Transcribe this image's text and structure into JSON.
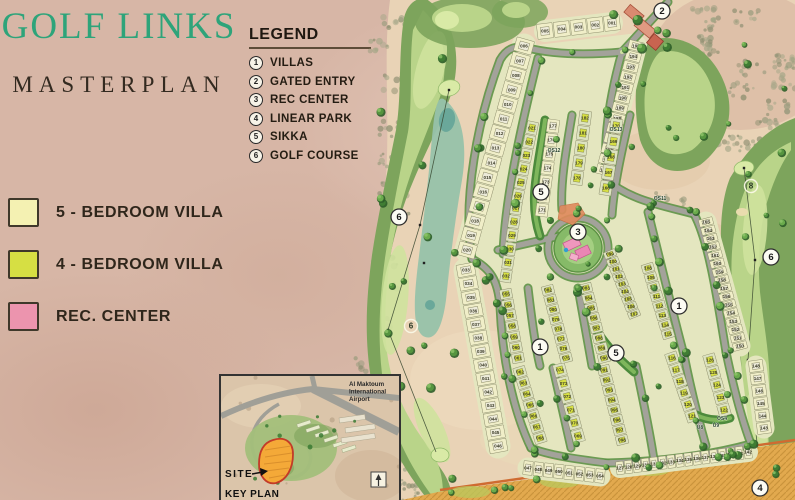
{
  "header": {
    "title": "GOLF LINKS",
    "subtitle": "MASTERPLAN"
  },
  "legend": {
    "title": "LEGEND",
    "items": [
      {
        "num": "1",
        "label": "VILLAS"
      },
      {
        "num": "2",
        "label": "GATED ENTRY"
      },
      {
        "num": "3",
        "label": "REC CENTER"
      },
      {
        "num": "4",
        "label": "LINEAR PARK"
      },
      {
        "num": "5",
        "label": "SIKKA"
      },
      {
        "num": "6",
        "label": "GOLF COURSE"
      }
    ]
  },
  "color_key": [
    {
      "label": "5 - BEDROOM VILLA",
      "color": "#f4f1b2"
    },
    {
      "label": "4 - BEDROOM VILLA",
      "color": "#d6df43"
    },
    {
      "label": "REC. CENTER",
      "color": "#ec94ae"
    }
  ],
  "keyplan": {
    "title": "KEY PLAN",
    "site_label": "SITE",
    "airport_label": [
      "Al Maktoum",
      "International",
      "Airport"
    ]
  },
  "map": {
    "colors": {
      "sand": "#e9d3b6",
      "villa_ground": "#e4e6bf",
      "road": "#a3a29a",
      "hedge": "#5d9246",
      "rough": "#7da45c",
      "fairway": "#b9d489",
      "green_light": "#d9eaa6",
      "marsh": "#97c2aa",
      "plot5_fill": "#f0eec8",
      "plot4_fill": "#dde3c0",
      "house5": "#ecead9",
      "house4": "#d6df43",
      "rec_green": "#86ba68",
      "rec_pink": "#ea86b4",
      "park_orange": "#e2a94e",
      "entry_red": "#d98a70"
    },
    "markers": [
      {
        "n": "2",
        "x": 662,
        "y": 11
      },
      {
        "n": "5",
        "x": 541,
        "y": 192
      },
      {
        "n": "3",
        "x": 578,
        "y": 232
      },
      {
        "n": "1",
        "x": 679,
        "y": 306
      },
      {
        "n": "1",
        "x": 540,
        "y": 347
      },
      {
        "n": "5",
        "x": 616,
        "y": 353
      },
      {
        "n": "4",
        "x": 760,
        "y": 488
      },
      {
        "n": "6",
        "x": 399,
        "y": 217
      },
      {
        "n": "6",
        "x": 771,
        "y": 257
      }
    ],
    "hole_markers": [
      {
        "n": "6",
        "x": 411,
        "y": 326
      },
      {
        "n": "8",
        "x": 751,
        "y": 186
      }
    ],
    "os_labels": [
      {
        "t": "OS13",
        "x": 616,
        "y": 131
      },
      {
        "t": "OS12",
        "x": 554,
        "y": 152
      },
      {
        "t": "OS11",
        "x": 660,
        "y": 200
      },
      {
        "t": "OS4",
        "x": 722,
        "y": 420
      },
      {
        "t": "U8",
        "x": 700,
        "y": 429
      },
      {
        "t": "U9",
        "x": 716,
        "y": 427
      }
    ],
    "plot_rows": [
      {
        "a": 5,
        "b": 1,
        "x1": 545,
        "y1": 31,
        "x2": 612,
        "y2": 23,
        "d": 15,
        "k": "5"
      },
      {
        "a": 6,
        "b": 20,
        "x1": 524,
        "y1": 46,
        "x2": 467,
        "y2": 250,
        "d": 18,
        "k": "5"
      },
      {
        "a": 33,
        "b": 46,
        "x1": 466,
        "y1": 270,
        "x2": 498,
        "y2": 446,
        "d": 18,
        "k": "5"
      },
      {
        "a": 47,
        "b": 54,
        "x1": 528,
        "y1": 468,
        "x2": 600,
        "y2": 476,
        "d": 14,
        "k": "5"
      },
      {
        "a": 127,
        "b": 142,
        "x1": 620,
        "y1": 468,
        "x2": 748,
        "y2": 452,
        "d": 13,
        "k": "5"
      },
      {
        "a": 143,
        "b": 148,
        "x1": 764,
        "y1": 428,
        "x2": 756,
        "y2": 366,
        "d": 14,
        "k": "5"
      },
      {
        "a": 195,
        "b": 183,
        "x1": 636,
        "y1": 46,
        "x2": 604,
        "y2": 170,
        "d": 15,
        "k": "5"
      },
      {
        "a": 165,
        "b": 150,
        "x1": 706,
        "y1": 222,
        "x2": 740,
        "y2": 346,
        "d": 14,
        "k": "5"
      },
      {
        "a": 21,
        "b": 26,
        "x1": 532,
        "y1": 128,
        "x2": 518,
        "y2": 196,
        "d": 11,
        "k": "4"
      },
      {
        "a": 27,
        "b": 32,
        "x1": 516,
        "y1": 208,
        "x2": 506,
        "y2": 276,
        "d": 11,
        "k": "4"
      },
      {
        "a": 55,
        "b": 61,
        "x1": 506,
        "y1": 294,
        "x2": 518,
        "y2": 358,
        "d": 12,
        "k": "4"
      },
      {
        "a": 62,
        "b": 68,
        "x1": 520,
        "y1": 372,
        "x2": 540,
        "y2": 438,
        "d": 12,
        "k": "4"
      },
      {
        "a": 74,
        "b": 69,
        "x1": 560,
        "y1": 370,
        "x2": 578,
        "y2": 436,
        "d": 12,
        "k": "4"
      },
      {
        "a": 82,
        "b": 75,
        "x1": 548,
        "y1": 290,
        "x2": 566,
        "y2": 358,
        "d": 12,
        "k": "4"
      },
      {
        "a": 83,
        "b": 90,
        "x1": 586,
        "y1": 288,
        "x2": 604,
        "y2": 358,
        "d": 12,
        "k": "4"
      },
      {
        "a": 91,
        "b": 98,
        "x1": 604,
        "y1": 370,
        "x2": 622,
        "y2": 440,
        "d": 12,
        "k": "4"
      },
      {
        "a": 99,
        "b": 107,
        "x1": 610,
        "y1": 254,
        "x2": 634,
        "y2": 314,
        "d": 12,
        "k": "4"
      },
      {
        "a": 108,
        "b": 115,
        "x1": 648,
        "y1": 268,
        "x2": 668,
        "y2": 334,
        "d": 12,
        "k": "4"
      },
      {
        "a": 116,
        "b": 121,
        "x1": 672,
        "y1": 358,
        "x2": 692,
        "y2": 416,
        "d": 12,
        "k": "4"
      },
      {
        "a": 126,
        "b": 122,
        "x1": 710,
        "y1": 360,
        "x2": 724,
        "y2": 410,
        "d": 12,
        "k": "4"
      },
      {
        "a": 177,
        "b": 171,
        "x1": 553,
        "y1": 126,
        "x2": 542,
        "y2": 210,
        "d": 12,
        "k": "5"
      },
      {
        "a": 182,
        "b": 178,
        "x1": 585,
        "y1": 118,
        "x2": 577,
        "y2": 178,
        "d": 12,
        "k": "4"
      },
      {
        "a": 170,
        "b": 166,
        "x1": 616,
        "y1": 126,
        "x2": 606,
        "y2": 188,
        "d": 12,
        "k": "4"
      }
    ]
  }
}
